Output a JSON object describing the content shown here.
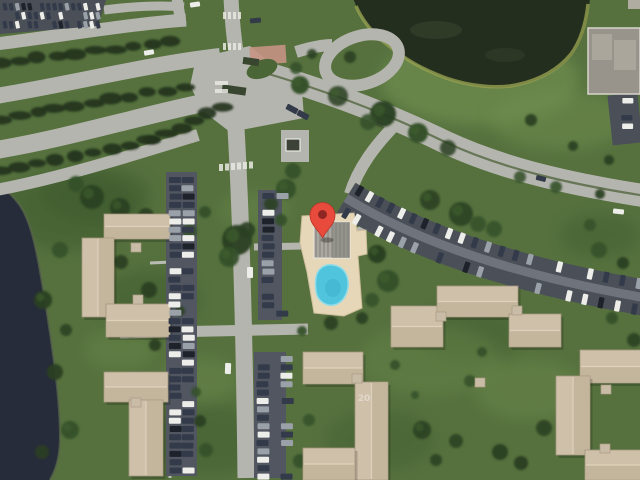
{
  "app": {
    "name": "satellite-map-view",
    "imagery_type": "aerial-satellite"
  },
  "marker": {
    "name": "map-pin",
    "color": "#E84A3C",
    "dot_color": "#8E2723",
    "x": 322,
    "y": 237
  },
  "labels": {
    "roof_number": "20"
  },
  "colors": {
    "grass": "#56713E",
    "grass_dark": "#3E5A2D",
    "grass_light": "#6F8E4F",
    "road": "#B5B5AF",
    "road_bright": "#C6C6BE",
    "asphalt": "#4A4F58",
    "aisle": "#757982",
    "pond": "#242E1F",
    "pond_shore": "#95A050",
    "lake": "#272C3A",
    "roof_tan": "#CFC0A9",
    "roof_tan_dark": "#BBAC94",
    "roof_ridge": "#DFD2BC",
    "roof_gray": "#98938B",
    "deck": "#E6D7B8",
    "pool": "#4FC4DC",
    "tree": "#2A3F22",
    "shrub": "#20301A",
    "car_white": "#EDEDE9",
    "car_dark": "#333A49",
    "car_gray": "#9BA1A9",
    "car_black": "#1E222B",
    "brick": "#C59384",
    "walk": "#C6C6C0",
    "booth": "#3C4238",
    "median_green": "#4E6238"
  },
  "features": {
    "pond": "retention pond",
    "lake": "lake shoreline",
    "pool": "swimming pool",
    "pool_deck": "pool deck",
    "clubhouse": "pool clubhouse",
    "entrance": "community entrance intersection",
    "gatehouse": "gatehouse booth",
    "boulevard": "curved boulevard",
    "parking": "parking lots with cars",
    "apartments": "apartment buildings",
    "marker": "red location pin"
  }
}
